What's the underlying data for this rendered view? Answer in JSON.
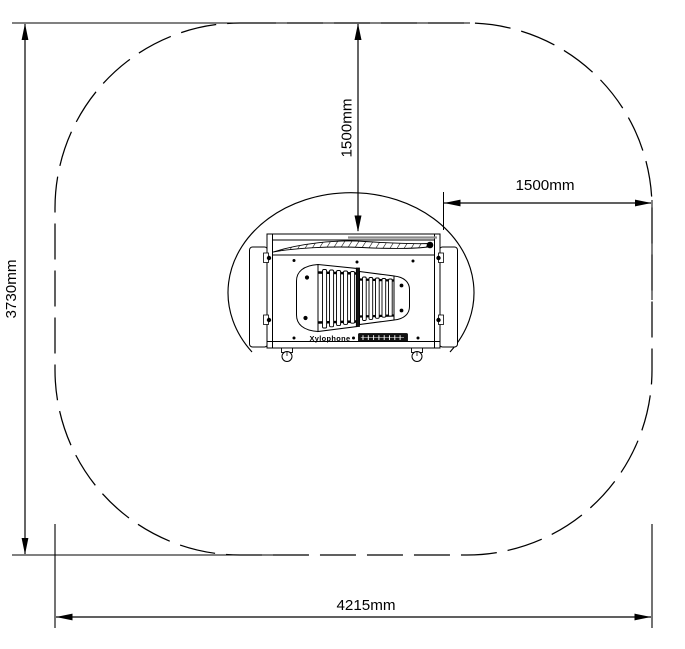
{
  "colors": {
    "line": "#000000",
    "background": "#ffffff",
    "gray_extension": "#8c8c8c",
    "badge_fill": "#111111"
  },
  "safety_zone": {
    "total_width_label": "4215mm",
    "total_height_label": "3730mm",
    "clearance_top_label": "1500mm",
    "clearance_right_label": "1500mm",
    "boundary_style": "dashed rounded rectangle",
    "impact_area_style": "solid oval arc around equipment"
  },
  "equipment": {
    "name_label": "Xylophone",
    "left_bar_count": 5,
    "right_bar_count": 5
  }
}
